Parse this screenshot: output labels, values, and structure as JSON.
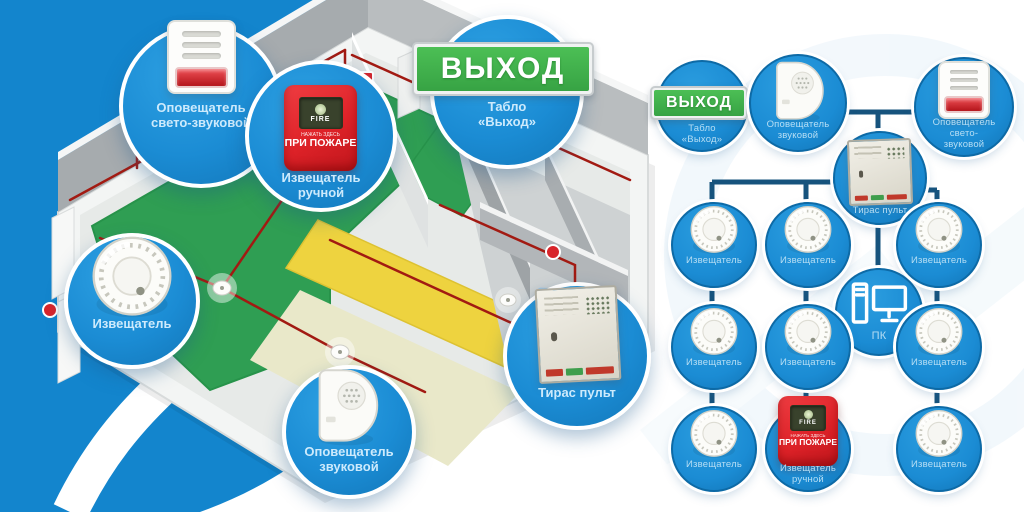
{
  "colors": {
    "background_blue": "#1385cd",
    "node_blue": "#1b8cd4",
    "connector_blue": "#16537d",
    "exit_green": "#3cae4b",
    "alarm_red": "#de2228",
    "wire_red": "#a21a12",
    "floor_green": "#2f9e53",
    "floor_yellow": "#eed33f",
    "label_light_blue": "#b7def4"
  },
  "scene_callouts": {
    "strobe": "Оповещатель свето-звуковой",
    "manual_call_point": "Извещатель ручной",
    "exit_board": "Табло «Выход»",
    "smoke_detector": "Извещатель",
    "sounder": "Оповещатель звуковой",
    "control_panel": "Тирас пульт"
  },
  "schematic_nodes": {
    "exit_board": "Табло «Выход»",
    "sounder": "Оповещатель звуковой",
    "strobe": "Оповещатель свето-звуковой",
    "control_panel": "Тирас пульт",
    "pc": "ПК",
    "manual_call_point": "Извещатель ручной",
    "smoke_detector": "Извещатель"
  },
  "device_text": {
    "exit_sign": "ВЫХОД",
    "fire": "FIRE",
    "press_here": "НАЖАТЬ ЗДЕСЬ",
    "in_case_of_fire": "ПРИ ПОЖАРЕ"
  }
}
